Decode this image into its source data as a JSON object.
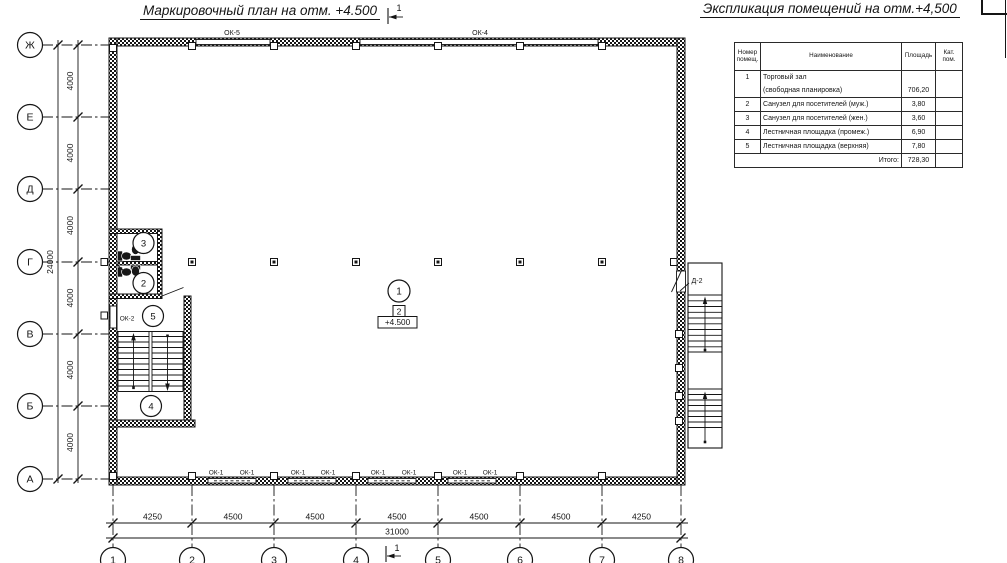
{
  "titles": {
    "plan": "Маркировочный план на отм. +4.500",
    "schedule": "Экспликация помещений на отм.+4,500"
  },
  "section_mark": "1",
  "table": {
    "headers": [
      "Номер помещ.",
      "Наименование",
      "Площадь",
      "Кат. пом."
    ],
    "rows": [
      {
        "num": "1",
        "name": "Торговый зал",
        "area": "",
        "cat": ""
      },
      {
        "num": "",
        "name": "(свободная планировка)",
        "area": "706,20",
        "cat": ""
      },
      {
        "num": "2",
        "name": "Санузел для посетителей (муж.)",
        "area": "3,80",
        "cat": ""
      },
      {
        "num": "3",
        "name": "Санузел для посетителей (жен.)",
        "area": "3,60",
        "cat": ""
      },
      {
        "num": "4",
        "name": "Лестничная площадка (промеж.)",
        "area": "6,90",
        "cat": ""
      },
      {
        "num": "5",
        "name": "Лестничная площадка (верхняя)",
        "area": "7,80",
        "cat": ""
      },
      {
        "num": "",
        "name": "Итого:",
        "area": "728,30",
        "cat": ""
      }
    ]
  },
  "axes": {
    "rows": [
      "Ж",
      "Е",
      "Д",
      "Г",
      "В",
      "Б",
      "А"
    ],
    "cols": [
      "1",
      "2",
      "3",
      "4",
      "5",
      "6",
      "7",
      "8"
    ]
  },
  "dims": {
    "left": [
      "4000",
      "4000",
      "4000",
      "4000",
      "4000",
      "4000"
    ],
    "left_total": "24000",
    "bottom": [
      "4250",
      "4500",
      "4500",
      "4500",
      "4500",
      "4500",
      "4250"
    ],
    "bottom_total": "31000"
  },
  "labels": {
    "ok5": "ОК-5",
    "ok4": "ОК-4",
    "ok2": "ОК-2",
    "d2": "Д-2",
    "ok1": [
      "ОК-1",
      "ОК-1",
      "ОК-1",
      "ОК-1",
      "ОК-1",
      "ОК-1",
      "ОК-1",
      "ОК-1"
    ]
  },
  "marks": {
    "room1": "1",
    "room2": "2",
    "room3": "3",
    "room4": "4",
    "room5": "5",
    "floor_type": "2",
    "elevation": "+4.500"
  },
  "colors": {
    "line": "#151515",
    "background": "#ffffff"
  }
}
